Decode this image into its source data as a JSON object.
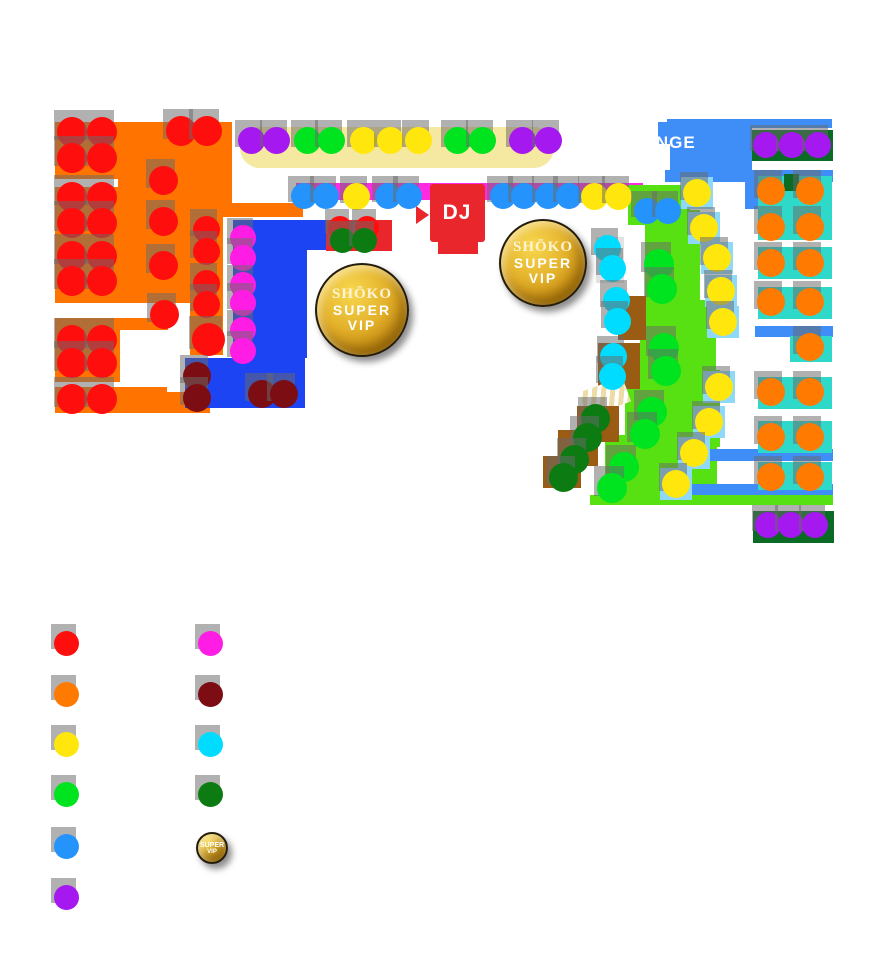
{
  "palette": {
    "r": "#ff0e0e",
    "o": "#ff7a00",
    "y": "#ffe70d",
    "g": "#00e41f",
    "b": "#2493fc",
    "p": "#a518f0",
    "m": "#ff1ce4",
    "mr": "#7c0d12",
    "c": "#00dcff",
    "dg": "#0c7c12"
  },
  "map": {
    "labels": [
      {
        "name": "dj-label",
        "text": "DJ",
        "x": 457,
        "y": 213,
        "fs": 21,
        "ls": 1,
        "center": true
      },
      {
        "name": "lounge-label",
        "text": "LOUNGE",
        "x": 617,
        "y": 133,
        "fs": 17,
        "ls": 1,
        "center": false
      }
    ],
    "badges": [
      {
        "name": "super-vip-badge",
        "x": 360,
        "y": 308,
        "r": 45,
        "lines": [
          "SHŌKO",
          "SUPER",
          "VIP"
        ]
      },
      {
        "name": "super-vip-badge",
        "x": 541,
        "y": 261,
        "r": 42,
        "lines": [
          "SHŌKO",
          "SUPER",
          "VIP"
        ]
      }
    ],
    "areas": [
      {
        "n": "stage-bar",
        "x": 240,
        "y": 127,
        "w": 314,
        "h": 41,
        "c": "#f5e8a0",
        "r": 20
      },
      {
        "n": "orange-zone",
        "x": 55,
        "y": 122,
        "w": 177,
        "h": 57,
        "c": "#ff7301"
      },
      {
        "n": "orange-zone",
        "x": 118,
        "y": 122,
        "w": 114,
        "h": 88,
        "c": "#ff7301"
      },
      {
        "n": "orange-zone",
        "x": 55,
        "y": 187,
        "w": 168,
        "h": 116,
        "c": "#ff7301"
      },
      {
        "n": "orange-zone",
        "x": 190,
        "y": 215,
        "w": 33,
        "h": 140,
        "c": "#ff7301"
      },
      {
        "n": "orange-zone",
        "x": 155,
        "y": 203,
        "w": 148,
        "h": 14,
        "c": "#ff7301"
      },
      {
        "n": "orange-zone",
        "x": 55,
        "y": 318,
        "w": 113,
        "h": 12,
        "c": "#ff7301"
      },
      {
        "n": "orange-zone",
        "x": 55,
        "y": 330,
        "w": 65,
        "h": 52,
        "c": "#ff7301"
      },
      {
        "n": "orange-zone",
        "x": 55,
        "y": 387,
        "w": 112,
        "h": 26,
        "c": "#ff7301"
      },
      {
        "n": "orange-zone",
        "x": 167,
        "y": 392,
        "w": 43,
        "h": 21,
        "c": "#ff7301"
      },
      {
        "n": "dj-rail",
        "x": 296,
        "y": 183,
        "w": 347,
        "h": 17,
        "c": "#ff2be3"
      },
      {
        "n": "blue-vip-zone",
        "x": 233,
        "y": 220,
        "w": 93,
        "h": 30,
        "c": "#1c44f2",
        "cls": "bstripe"
      },
      {
        "n": "blue-vip-zone",
        "x": 233,
        "y": 250,
        "w": 74,
        "h": 108,
        "c": "#1c44f2",
        "cls": "bstripe"
      },
      {
        "n": "blue-vip-zone",
        "x": 185,
        "y": 358,
        "w": 120,
        "h": 50,
        "c": "#1c44f2",
        "cls": "bstripe"
      },
      {
        "n": "red-table",
        "x": 326,
        "y": 220,
        "w": 66,
        "h": 31,
        "c": "#e8262b"
      },
      {
        "n": "lounge-zone",
        "x": 667,
        "y": 119,
        "w": 165,
        "h": 9,
        "c": "#3f8ef7"
      },
      {
        "n": "lounge-zone",
        "x": 658,
        "y": 122,
        "w": 14,
        "h": 22,
        "c": "#3f8ef7"
      },
      {
        "n": "lounge-zone",
        "x": 670,
        "y": 128,
        "w": 82,
        "h": 50,
        "c": "#3f8ef7"
      },
      {
        "n": "lounge-zone",
        "x": 665,
        "y": 170,
        "w": 168,
        "h": 12,
        "c": "#3f8ef7"
      },
      {
        "n": "lounge-zone",
        "x": 745,
        "y": 177,
        "w": 13,
        "h": 32,
        "c": "#3f8ef7"
      },
      {
        "n": "vip-bench",
        "x": 752,
        "y": 130,
        "w": 81,
        "h": 31,
        "c": "#0a6b25",
        "cls": "dgbar"
      },
      {
        "n": "dance-floor",
        "x": 628,
        "y": 185,
        "w": 62,
        "h": 40,
        "c": "#57e112"
      },
      {
        "n": "dance-floor",
        "x": 645,
        "y": 210,
        "w": 55,
        "h": 102,
        "c": "#57e112"
      },
      {
        "n": "dance-floor",
        "x": 640,
        "y": 300,
        "w": 76,
        "h": 82,
        "c": "#57e112"
      },
      {
        "n": "dance-floor",
        "x": 625,
        "y": 370,
        "w": 95,
        "h": 77,
        "c": "#57e112"
      },
      {
        "n": "dance-floor",
        "x": 605,
        "y": 435,
        "w": 112,
        "h": 62,
        "c": "#57e112"
      },
      {
        "n": "dance-floor",
        "x": 590,
        "y": 495,
        "w": 243,
        "h": 10,
        "c": "#57e112"
      },
      {
        "n": "walkway",
        "x": 755,
        "y": 326,
        "w": 78,
        "h": 11,
        "c": "#3f8ef7"
      },
      {
        "n": "walkway",
        "x": 705,
        "y": 449,
        "w": 128,
        "h": 12,
        "c": "#3f8ef7"
      },
      {
        "n": "walkway",
        "x": 687,
        "y": 484,
        "w": 146,
        "h": 11,
        "c": "#3f8ef7"
      },
      {
        "n": "table",
        "x": 758,
        "y": 176,
        "w": 74,
        "h": 64,
        "c": "#2fd9c9",
        "cls": "teal"
      },
      {
        "n": "table",
        "x": 758,
        "y": 247,
        "w": 74,
        "h": 32,
        "c": "#2fd9c9",
        "cls": "teal"
      },
      {
        "n": "table",
        "x": 758,
        "y": 287,
        "w": 74,
        "h": 32,
        "c": "#2fd9c9",
        "cls": "teal"
      },
      {
        "n": "table",
        "x": 790,
        "y": 336,
        "w": 42,
        "h": 26,
        "c": "#2fd9c9",
        "cls": "teal"
      },
      {
        "n": "table",
        "x": 758,
        "y": 377,
        "w": 74,
        "h": 32,
        "c": "#2fd9c9",
        "cls": "teal"
      },
      {
        "n": "table",
        "x": 758,
        "y": 421,
        "w": 74,
        "h": 32,
        "c": "#2fd9c9",
        "cls": "teal"
      },
      {
        "n": "table",
        "x": 758,
        "y": 462,
        "w": 74,
        "h": 28,
        "c": "#2fd9c9",
        "cls": "teal"
      },
      {
        "n": "vip-bench",
        "x": 784,
        "y": 174,
        "w": 15,
        "h": 17,
        "c": "#0a6b25"
      },
      {
        "n": "vip-bench",
        "x": 753,
        "y": 511,
        "w": 81,
        "h": 32,
        "c": "#0a6b25",
        "cls": "dgbar"
      },
      {
        "n": "seat-pad",
        "x": 681,
        "y": 177,
        "w": 32,
        "h": 32,
        "c": "#8ed9f8"
      },
      {
        "n": "seat-pad",
        "x": 688,
        "y": 212,
        "w": 32,
        "h": 32,
        "c": "#8ed9f8"
      },
      {
        "n": "seat-pad",
        "x": 701,
        "y": 242,
        "w": 32,
        "h": 32,
        "c": "#8ed9f8"
      },
      {
        "n": "seat-pad",
        "x": 705,
        "y": 275,
        "w": 32,
        "h": 32,
        "c": "#8ed9f8"
      },
      {
        "n": "seat-pad",
        "x": 707,
        "y": 306,
        "w": 32,
        "h": 32,
        "c": "#8ed9f8"
      },
      {
        "n": "seat-pad",
        "x": 703,
        "y": 371,
        "w": 32,
        "h": 32,
        "c": "#8ed9f8"
      },
      {
        "n": "seat-pad",
        "x": 693,
        "y": 406,
        "w": 32,
        "h": 32,
        "c": "#8ed9f8"
      },
      {
        "n": "seat-pad",
        "x": 678,
        "y": 437,
        "w": 32,
        "h": 32,
        "c": "#8ed9f8"
      },
      {
        "n": "seat-pad",
        "x": 660,
        "y": 468,
        "w": 32,
        "h": 32,
        "c": "#8ed9f8"
      },
      {
        "n": "table",
        "x": 596,
        "y": 237,
        "w": 28,
        "h": 46,
        "c": "#e2e2e2"
      },
      {
        "n": "table",
        "x": 618,
        "y": 296,
        "w": 28,
        "h": 44,
        "c": "#9a5b13"
      },
      {
        "n": "table",
        "x": 598,
        "y": 343,
        "w": 42,
        "h": 46,
        "c": "#9a5b13"
      },
      {
        "n": "stairs",
        "x": 582,
        "y": 384,
        "w": 46,
        "h": 26,
        "c": "",
        "cls": "stairs",
        "rot": -20
      },
      {
        "n": "stairs-landing",
        "x": 577,
        "y": 406,
        "w": 42,
        "h": 36,
        "c": "#9a5b13"
      },
      {
        "n": "stairs-landing",
        "x": 558,
        "y": 430,
        "w": 40,
        "h": 36,
        "c": "#9a5b13"
      },
      {
        "n": "stairs-landing",
        "x": 543,
        "y": 456,
        "w": 38,
        "h": 32,
        "c": "#9a5b13"
      },
      {
        "n": "dj-booth",
        "x": 430,
        "y": 184,
        "w": 55,
        "h": 58,
        "c": "#e8262b",
        "r": 3
      },
      {
        "n": "dj-booth",
        "x": 438,
        "y": 242,
        "w": 40,
        "h": 12,
        "c": "#e8262b"
      },
      {
        "n": "dj-arrow",
        "x": 416,
        "y": 206,
        "w": 0,
        "h": 0,
        "c": "",
        "cls": "tri"
      }
    ],
    "seats": [
      [
        72,
        132,
        "r",
        30
      ],
      [
        102,
        132,
        "r",
        30
      ],
      [
        72,
        158,
        "r",
        30
      ],
      [
        102,
        158,
        "r",
        30
      ],
      [
        181,
        131,
        "r",
        30
      ],
      [
        207,
        131,
        "r",
        30
      ],
      [
        163,
        180,
        "r",
        29
      ],
      [
        163,
        221,
        "r",
        29
      ],
      [
        163,
        265,
        "r",
        29
      ],
      [
        164,
        314,
        "r",
        29
      ],
      [
        72,
        197,
        "r",
        30
      ],
      [
        102,
        197,
        "r",
        30
      ],
      [
        72,
        223,
        "r",
        30
      ],
      [
        102,
        223,
        "r",
        30
      ],
      [
        72,
        256,
        "r",
        30
      ],
      [
        102,
        256,
        "r",
        30
      ],
      [
        72,
        281,
        "r",
        30
      ],
      [
        102,
        281,
        "r",
        30
      ],
      [
        206,
        229,
        "r",
        27
      ],
      [
        206,
        251,
        "r",
        27
      ],
      [
        206,
        283,
        "r",
        27
      ],
      [
        206,
        304,
        "r",
        27
      ],
      [
        208,
        339,
        "r",
        33
      ],
      [
        72,
        340,
        "r",
        30
      ],
      [
        102,
        340,
        "r",
        30
      ],
      [
        72,
        363,
        "r",
        30
      ],
      [
        102,
        363,
        "r",
        30
      ],
      [
        72,
        399,
        "r",
        30
      ],
      [
        102,
        399,
        "r",
        30
      ],
      [
        251,
        140,
        "p",
        27
      ],
      [
        276,
        140,
        "p",
        27
      ],
      [
        522,
        140,
        "p",
        27
      ],
      [
        548,
        140,
        "p",
        27
      ],
      [
        307,
        140,
        "g",
        27
      ],
      [
        331,
        140,
        "g",
        27
      ],
      [
        457,
        140,
        "g",
        27
      ],
      [
        482,
        140,
        "g",
        27
      ],
      [
        363,
        140,
        "y",
        27
      ],
      [
        390,
        140,
        "y",
        27
      ],
      [
        418,
        140,
        "y",
        27
      ],
      [
        304,
        196,
        "b",
        26
      ],
      [
        326,
        196,
        "b",
        26
      ],
      [
        388,
        196,
        "b",
        26
      ],
      [
        409,
        196,
        "b",
        26
      ],
      [
        356,
        196,
        "y",
        27
      ],
      [
        503,
        196,
        "b",
        26
      ],
      [
        524,
        196,
        "b",
        26
      ],
      [
        548,
        196,
        "b",
        26
      ],
      [
        569,
        196,
        "b",
        26
      ],
      [
        594,
        196,
        "y",
        27
      ],
      [
        618,
        196,
        "y",
        27
      ],
      [
        647,
        211,
        "b",
        26
      ],
      [
        668,
        211,
        "b",
        26
      ],
      [
        697,
        193,
        "y",
        28
      ],
      [
        704,
        228,
        "y",
        28
      ],
      [
        717,
        258,
        "y",
        28
      ],
      [
        721,
        291,
        "y",
        28
      ],
      [
        723,
        322,
        "y",
        28
      ],
      [
        719,
        387,
        "y",
        28
      ],
      [
        709,
        422,
        "y",
        28
      ],
      [
        694,
        453,
        "y",
        28
      ],
      [
        676,
        484,
        "y",
        28
      ],
      [
        659,
        264,
        "g",
        30
      ],
      [
        662,
        289,
        "g",
        30
      ],
      [
        664,
        348,
        "g",
        30
      ],
      [
        666,
        371,
        "g",
        30
      ],
      [
        652,
        412,
        "g",
        30
      ],
      [
        645,
        434,
        "g",
        30
      ],
      [
        624,
        467,
        "g",
        30
      ],
      [
        612,
        488,
        "g",
        30
      ],
      [
        243,
        238,
        "m",
        26
      ],
      [
        243,
        258,
        "m",
        26
      ],
      [
        243,
        285,
        "m",
        26
      ],
      [
        243,
        303,
        "m",
        26
      ],
      [
        243,
        330,
        "m",
        26
      ],
      [
        243,
        351,
        "m",
        26
      ],
      [
        197,
        376,
        "mr",
        28
      ],
      [
        197,
        398,
        "mr",
        28
      ],
      [
        262,
        394,
        "mr",
        28
      ],
      [
        284,
        394,
        "mr",
        28
      ],
      [
        340,
        228,
        "r",
        24
      ],
      [
        367,
        228,
        "r",
        24
      ],
      [
        342,
        240,
        "dg",
        25
      ],
      [
        364,
        240,
        "dg",
        25
      ],
      [
        607,
        248,
        "c",
        27
      ],
      [
        612,
        268,
        "c",
        27
      ],
      [
        616,
        300,
        "c",
        27
      ],
      [
        617,
        321,
        "c",
        27
      ],
      [
        613,
        356,
        "c",
        27
      ],
      [
        612,
        376,
        "c",
        27
      ],
      [
        595,
        418,
        "dg",
        29
      ],
      [
        587,
        437,
        "dg",
        29
      ],
      [
        574,
        459,
        "dg",
        29
      ],
      [
        563,
        477,
        "dg",
        29
      ],
      [
        771,
        191,
        "o",
        28
      ],
      [
        810,
        191,
        "o",
        28
      ],
      [
        771,
        227,
        "o",
        28
      ],
      [
        810,
        227,
        "o",
        28
      ],
      [
        771,
        263,
        "o",
        28
      ],
      [
        810,
        263,
        "o",
        28
      ],
      [
        771,
        302,
        "o",
        28
      ],
      [
        810,
        302,
        "o",
        28
      ],
      [
        810,
        347,
        "o",
        28
      ],
      [
        771,
        392,
        "o",
        28
      ],
      [
        810,
        392,
        "o",
        28
      ],
      [
        771,
        437,
        "o",
        28
      ],
      [
        810,
        437,
        "o",
        28
      ],
      [
        771,
        477,
        "o",
        28
      ],
      [
        810,
        477,
        "o",
        28
      ],
      [
        766,
        145,
        "p",
        26
      ],
      [
        792,
        145,
        "p",
        26
      ],
      [
        818,
        145,
        "p",
        26
      ],
      [
        768,
        525,
        "p",
        26
      ],
      [
        791,
        525,
        "p",
        26
      ],
      [
        815,
        525,
        "p",
        26
      ]
    ]
  },
  "legend": {
    "items": [
      {
        "key": "red",
        "color": "#ff0e0e",
        "x": 66,
        "y": 643
      },
      {
        "key": "orange",
        "color": "#ff7a00",
        "x": 66,
        "y": 694
      },
      {
        "key": "yellow",
        "color": "#ffe70d",
        "x": 66,
        "y": 744
      },
      {
        "key": "green",
        "color": "#00e41f",
        "x": 66,
        "y": 794
      },
      {
        "key": "blue",
        "color": "#2493fc",
        "x": 66,
        "y": 846
      },
      {
        "key": "purple",
        "color": "#a518f0",
        "x": 66,
        "y": 897
      },
      {
        "key": "magenta",
        "color": "#ff1ce4",
        "x": 210,
        "y": 643
      },
      {
        "key": "maroon",
        "color": "#7c0d12",
        "x": 210,
        "y": 694
      },
      {
        "key": "cyan",
        "color": "#00dcff",
        "x": 210,
        "y": 744
      },
      {
        "key": "darkgreen",
        "color": "#0c7c12",
        "x": 210,
        "y": 794
      }
    ],
    "vip": {
      "x": 210,
      "y": 846,
      "r": 14,
      "lines": [
        "SUPER",
        "VIP"
      ]
    }
  }
}
